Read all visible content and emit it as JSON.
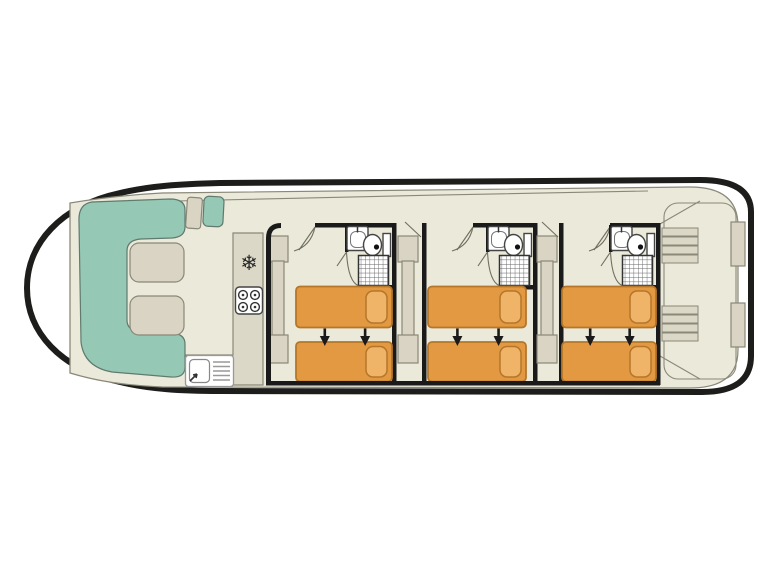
{
  "plan": {
    "type": "boat-deck-plan",
    "bow_saloon": {
      "bench_seats": 1,
      "tables": 2,
      "helm_seats": 2
    },
    "galley": {
      "fridge_glyph": "❄",
      "appliances": [
        "refrigerator-icon",
        "stove-4-burner-icon",
        "sink-with-drainer-icon"
      ]
    },
    "cabins": [
      {
        "beds": 2,
        "bathroom": [
          "washbasin-icon",
          "toilet-icon",
          "shower-icon"
        ],
        "wardrobe": true
      },
      {
        "beds": 2,
        "bathroom": [
          "washbasin-icon",
          "toilet-icon",
          "shower-icon"
        ],
        "wardrobe": true
      },
      {
        "beds": 2,
        "bathroom": [
          "washbasin-icon",
          "toilet-icon",
          "shower-icon"
        ],
        "wardrobe": true
      }
    ],
    "stern": {
      "staircases": 2,
      "lockers": 2
    }
  },
  "colors": {
    "hull": "#1d1d1b",
    "wall": "#1a1a1a",
    "floor": "#ebe9d9",
    "bench": "#96c8b6",
    "furniture": "#d9d4c3",
    "counter": "#dcd8c8",
    "outline": "#8a8878",
    "bed": "#e39942",
    "pillow": "#f0b469",
    "bedline": "#b5762a"
  }
}
